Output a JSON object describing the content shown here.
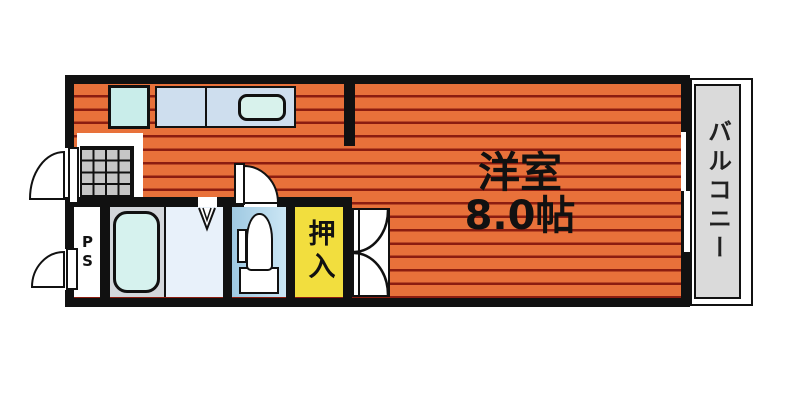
{
  "floorplan": {
    "rooms": {
      "main_room": {
        "name": "洋室",
        "size": "8.0帖"
      },
      "closet": {
        "label": "押入"
      },
      "balcony": {
        "label": "バルコニー"
      },
      "pipe_space": {
        "label": "PS"
      }
    },
    "fixtures": [
      "stove",
      "kitchen-sink",
      "entrance-tiles",
      "bathtub",
      "toilet",
      "folding-door",
      "closet-double-doors",
      "sliding-window",
      "entrance-door",
      "pipe-space-door",
      "toilet-door"
    ],
    "colors": {
      "floor_orange": "#E8713A",
      "floor_stripe_line": "#8C1D10",
      "closet_yellow": "#F2DE3E",
      "balcony_gray": "#DADADA",
      "wall_black": "#111111",
      "toilet_blue": "#9FC9E2",
      "bath_gray": "#D3D7DB",
      "fixture_cyan": "#D6F2EE"
    }
  }
}
